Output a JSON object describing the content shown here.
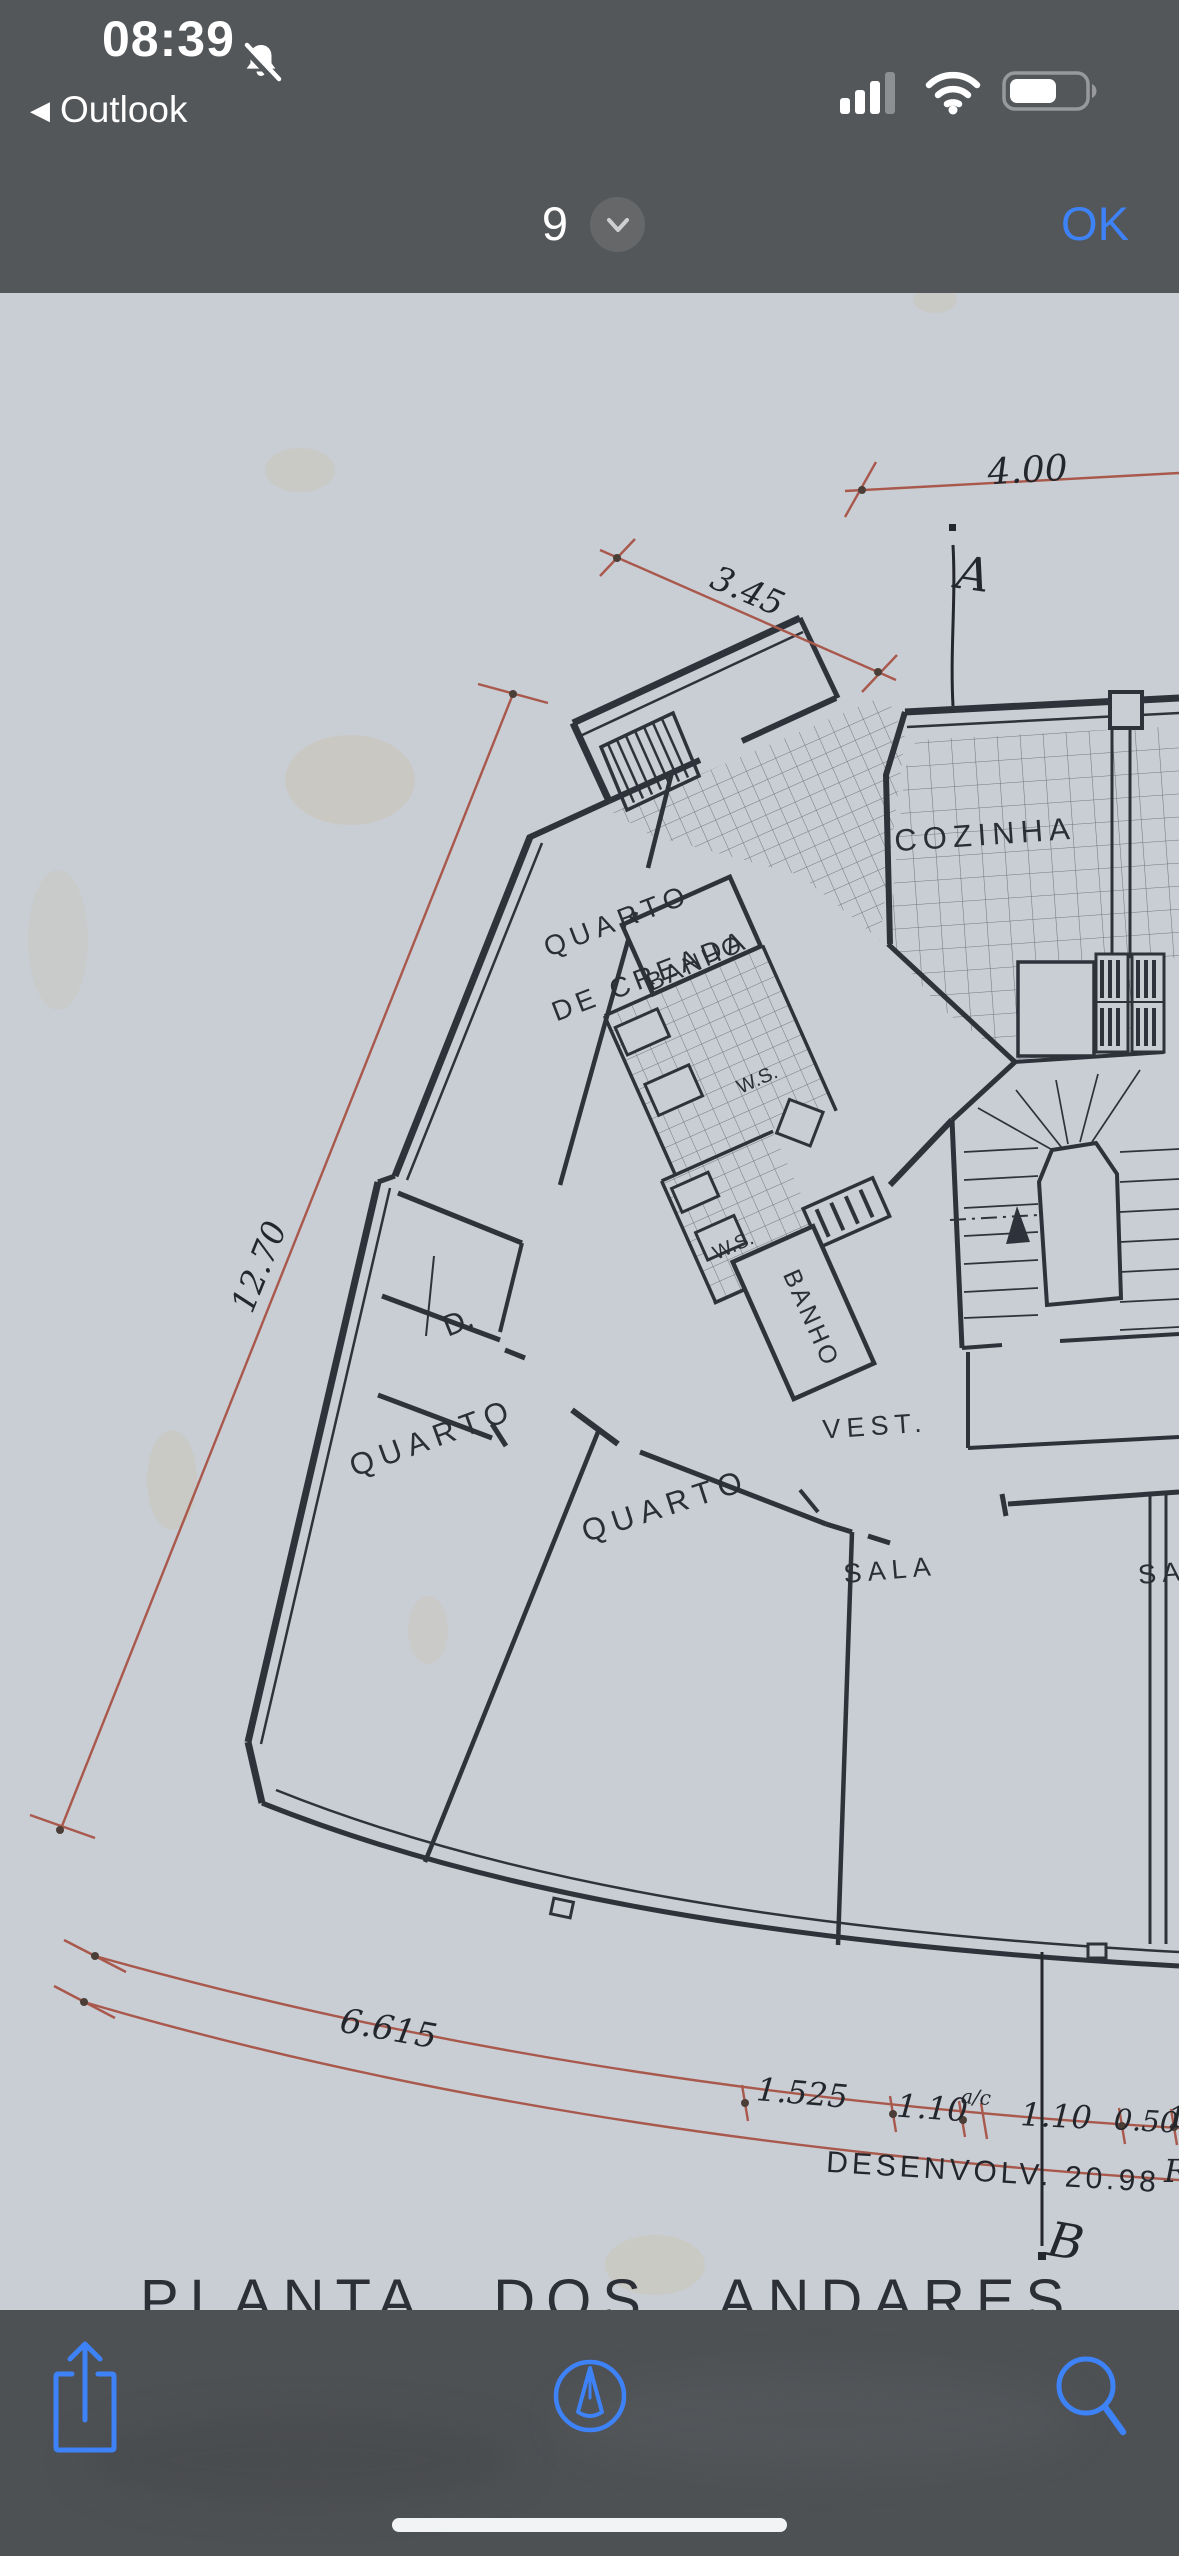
{
  "colors": {
    "ios_blue": "#3E82F7",
    "chrome_bg": "#54575A",
    "toolbar_bg": "#4E5154",
    "paper": "#C9CDD4",
    "ink": "#2E323A",
    "dimension_red": "#A9584C"
  },
  "status_bar": {
    "time": "08:39",
    "back_chevron": "◀",
    "back_app": "Outlook"
  },
  "nav_bar": {
    "page_indicator": "9",
    "confirm_label": "OK"
  },
  "plan": {
    "title": "PLANTA DOS ANDARES",
    "rooms": {
      "cozinha": "COZINHA",
      "quarto_creada_line1": "QUARTO",
      "quarto_creada_line2": "DE CREADA",
      "banho_upper": "BANHO",
      "banho_lower": "BANHO",
      "wc_upper": "W.S.",
      "wc_lower": "W.S.",
      "closet": "D.",
      "quarto_left": "QUARTO",
      "quarto_middle": "QUARTO",
      "vestibule": "VEST.",
      "sala": "SALA",
      "sala_neighbor_partial": "SA"
    },
    "dimensions": {
      "top_width": "4.00",
      "balcony_width": "3.45",
      "side_length": "12.70",
      "facade_left": "6.615",
      "seg1": "1.525",
      "seg2": "1.10",
      "seg2_note": "a/c",
      "seg3": "1.10",
      "seg4": "0.50",
      "seg5_partial": "1",
      "development": "DESENVOLV. 20.98",
      "development_partial": "R"
    },
    "section_markers": {
      "top": "A",
      "bottom": "B"
    }
  },
  "toolbar": {
    "share_icon": "share-icon",
    "markup_icon": "markup-icon",
    "search_icon": "search-icon"
  }
}
